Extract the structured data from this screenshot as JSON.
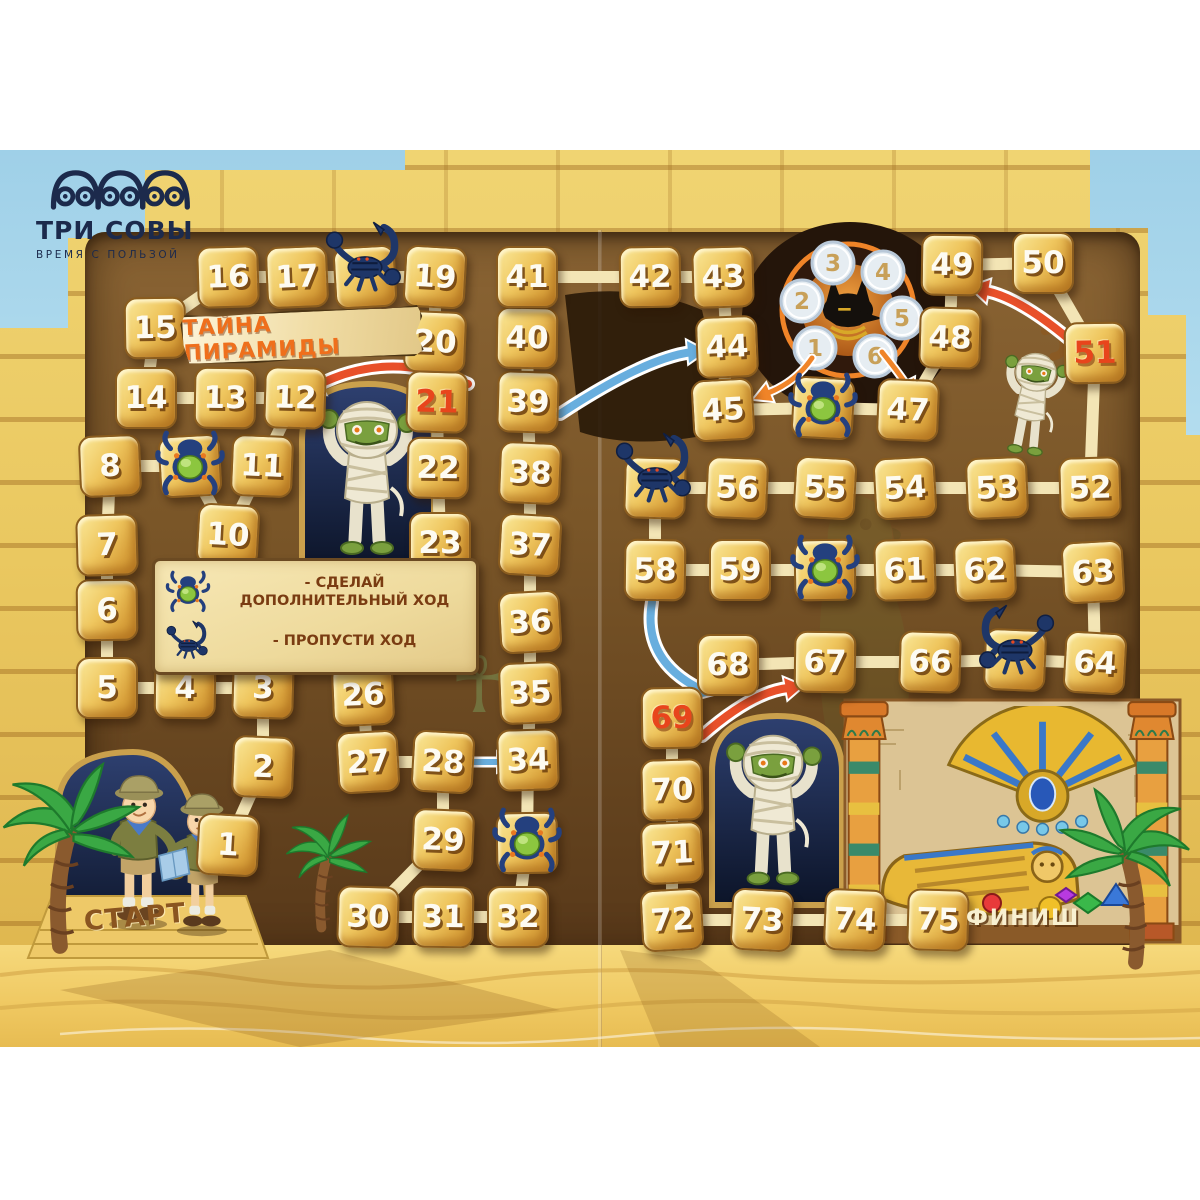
{
  "brand": {
    "name": "ТРИ СОВЫ",
    "tagline": "ВРЕМЯ С ПОЛЬЗОЙ"
  },
  "title": "ТАЙНА ПИРАМИДЫ",
  "labels": {
    "start": "СТАРТ",
    "finish": "ФИНИШ"
  },
  "legend": {
    "items": [
      {
        "icon": "scarab-icon",
        "text": "- СДЕЛАЙ ДОПОЛНИТЕЛЬНЫЙ ХОД"
      },
      {
        "icon": "scorpion-icon",
        "text": "- ПРОПУСТИ ХОД"
      }
    ]
  },
  "colors": {
    "accent_red": "#e8502a",
    "arrow_blue": "#68aede",
    "arrow_orange": "#f08428",
    "path_cream": "#f3e5b5",
    "tile_gold": "#edbf55",
    "panel_brown": "#74522a",
    "sky": "#a8d6ea",
    "sand": "#f2cf6e",
    "logo_navy": "#1c2a4c",
    "title_orange": "#ef6f1c"
  },
  "spinner": {
    "cx": 848,
    "cy": 310,
    "values": [
      {
        "v": "1",
        "x": 815,
        "y": 348
      },
      {
        "v": "2",
        "x": 802,
        "y": 301
      },
      {
        "v": "3",
        "x": 833,
        "y": 263
      },
      {
        "v": "4",
        "x": 883,
        "y": 272
      },
      {
        "v": "5",
        "x": 902,
        "y": 318
      },
      {
        "v": "6",
        "x": 875,
        "y": 356
      }
    ]
  },
  "board": {
    "tiles": [
      {
        "n": 1,
        "x": 228,
        "y": 845,
        "v": "n"
      },
      {
        "n": 2,
        "x": 263,
        "y": 767,
        "v": "n"
      },
      {
        "n": 3,
        "x": 263,
        "y": 688,
        "v": "n"
      },
      {
        "n": 4,
        "x": 185,
        "y": 688,
        "v": "n"
      },
      {
        "n": 5,
        "x": 107,
        "y": 688,
        "v": "n"
      },
      {
        "n": 6,
        "x": 107,
        "y": 610,
        "v": "n"
      },
      {
        "n": 7,
        "x": 107,
        "y": 545,
        "v": "n"
      },
      {
        "n": 8,
        "x": 110,
        "y": 466,
        "v": "n"
      },
      {
        "n": 9,
        "x": 190,
        "y": 466,
        "v": "scarab"
      },
      {
        "n": 10,
        "x": 228,
        "y": 535,
        "v": "n"
      },
      {
        "n": 11,
        "x": 262,
        "y": 466,
        "v": "n"
      },
      {
        "n": 12,
        "x": 295,
        "y": 398,
        "v": "n"
      },
      {
        "n": 13,
        "x": 225,
        "y": 398,
        "v": "n"
      },
      {
        "n": 14,
        "x": 146,
        "y": 398,
        "v": "n"
      },
      {
        "n": 15,
        "x": 155,
        "y": 328,
        "v": "n"
      },
      {
        "n": 16,
        "x": 228,
        "y": 277,
        "v": "n"
      },
      {
        "n": 17,
        "x": 297,
        "y": 277,
        "v": "n"
      },
      {
        "n": 18,
        "x": 365,
        "y": 277,
        "v": "scorpion"
      },
      {
        "n": 19,
        "x": 435,
        "y": 277,
        "v": "n"
      },
      {
        "n": 20,
        "x": 435,
        "y": 342,
        "v": "n"
      },
      {
        "n": 21,
        "x": 437,
        "y": 402,
        "v": "red"
      },
      {
        "n": 22,
        "x": 438,
        "y": 468,
        "v": "n"
      },
      {
        "n": 23,
        "x": 440,
        "y": 543,
        "v": "n"
      },
      {
        "n": 24,
        "x": 443,
        "y": 622,
        "v": "n"
      },
      {
        "n": 25,
        "x": 362,
        "y": 627,
        "v": "scarab"
      },
      {
        "n": 26,
        "x": 363,
        "y": 695,
        "v": "n"
      },
      {
        "n": 27,
        "x": 368,
        "y": 762,
        "v": "n"
      },
      {
        "n": 28,
        "x": 443,
        "y": 762,
        "v": "n"
      },
      {
        "n": 29,
        "x": 443,
        "y": 840,
        "v": "n"
      },
      {
        "n": 30,
        "x": 368,
        "y": 917,
        "v": "n"
      },
      {
        "n": 31,
        "x": 443,
        "y": 917,
        "v": "n"
      },
      {
        "n": 32,
        "x": 518,
        "y": 917,
        "v": "n"
      },
      {
        "n": 33,
        "x": 527,
        "y": 843,
        "v": "scarab"
      },
      {
        "n": 34,
        "x": 528,
        "y": 760,
        "v": "n"
      },
      {
        "n": 35,
        "x": 530,
        "y": 693,
        "v": "n"
      },
      {
        "n": 36,
        "x": 530,
        "y": 622,
        "v": "n"
      },
      {
        "n": 37,
        "x": 530,
        "y": 545,
        "v": "n"
      },
      {
        "n": 38,
        "x": 530,
        "y": 473,
        "v": "n"
      },
      {
        "n": 39,
        "x": 528,
        "y": 402,
        "v": "n"
      },
      {
        "n": 40,
        "x": 527,
        "y": 338,
        "v": "n"
      },
      {
        "n": 41,
        "x": 527,
        "y": 277,
        "v": "n"
      },
      {
        "n": 42,
        "x": 650,
        "y": 277,
        "v": "n"
      },
      {
        "n": 43,
        "x": 723,
        "y": 277,
        "v": "n"
      },
      {
        "n": 44,
        "x": 727,
        "y": 347,
        "v": "n"
      },
      {
        "n": 45,
        "x": 723,
        "y": 410,
        "v": "n"
      },
      {
        "n": 46,
        "x": 823,
        "y": 408,
        "v": "scarab"
      },
      {
        "n": 47,
        "x": 908,
        "y": 410,
        "v": "n"
      },
      {
        "n": 48,
        "x": 950,
        "y": 338,
        "v": "n"
      },
      {
        "n": 49,
        "x": 952,
        "y": 265,
        "v": "n"
      },
      {
        "n": 50,
        "x": 1043,
        "y": 263,
        "v": "n"
      },
      {
        "n": 51,
        "x": 1095,
        "y": 353,
        "v": "red"
      },
      {
        "n": 52,
        "x": 1090,
        "y": 488,
        "v": "n"
      },
      {
        "n": 53,
        "x": 997,
        "y": 488,
        "v": "n"
      },
      {
        "n": 54,
        "x": 905,
        "y": 488,
        "v": "n"
      },
      {
        "n": 55,
        "x": 825,
        "y": 488,
        "v": "n"
      },
      {
        "n": 56,
        "x": 737,
        "y": 488,
        "v": "n"
      },
      {
        "n": 57,
        "x": 655,
        "y": 488,
        "v": "scorpion"
      },
      {
        "n": 58,
        "x": 655,
        "y": 570,
        "v": "n"
      },
      {
        "n": 59,
        "x": 740,
        "y": 570,
        "v": "n"
      },
      {
        "n": 60,
        "x": 825,
        "y": 570,
        "v": "scarab"
      },
      {
        "n": 61,
        "x": 905,
        "y": 570,
        "v": "n"
      },
      {
        "n": 62,
        "x": 985,
        "y": 570,
        "v": "n"
      },
      {
        "n": 63,
        "x": 1093,
        "y": 572,
        "v": "n"
      },
      {
        "n": 64,
        "x": 1095,
        "y": 663,
        "v": "n"
      },
      {
        "n": 65,
        "x": 1015,
        "y": 660,
        "v": "scorpion"
      },
      {
        "n": 66,
        "x": 930,
        "y": 662,
        "v": "n"
      },
      {
        "n": 67,
        "x": 825,
        "y": 662,
        "v": "n"
      },
      {
        "n": 68,
        "x": 728,
        "y": 665,
        "v": "n"
      },
      {
        "n": 69,
        "x": 672,
        "y": 718,
        "v": "red"
      },
      {
        "n": 70,
        "x": 672,
        "y": 790,
        "v": "n"
      },
      {
        "n": 71,
        "x": 672,
        "y": 853,
        "v": "n"
      },
      {
        "n": 72,
        "x": 672,
        "y": 920,
        "v": "n"
      },
      {
        "n": 73,
        "x": 762,
        "y": 920,
        "v": "n"
      },
      {
        "n": 74,
        "x": 855,
        "y": 920,
        "v": "n"
      },
      {
        "n": 75,
        "x": 938,
        "y": 920,
        "v": "n"
      }
    ],
    "arrows": [
      {
        "name": "arrow-21-to-12",
        "color": "#e8502a",
        "w": 8,
        "uw": 14,
        "d": "M 468,384 Q 390,348 316,386",
        "head": "303,392 314,374 325,394"
      },
      {
        "name": "arrow-39-to-44",
        "color": "#68aede",
        "w": 8,
        "uw": 14,
        "d": "M 560,414 Q 645,358 692,352",
        "head": "706,351 689,363 687,341"
      },
      {
        "name": "arrow-28-to-34",
        "color": "#68aede",
        "w": 6,
        "uw": 11,
        "d": "M 470,762 L 500,762",
        "head": "512,762 498,771 498,753"
      },
      {
        "name": "arrow-51-to-49",
        "color": "#e8502a",
        "w": 8,
        "uw": 14,
        "d": "M 1070,340 Q 1020,298 986,291",
        "head": "970,287 990,280 986,302"
      },
      {
        "name": "arrow-58-to-68",
        "color": "#68aede",
        "w": 8,
        "uw": 14,
        "d": "M 652,602 Q 642,660 700,689",
        "head": "714,694 695,699 702,678"
      },
      {
        "name": "arrow-69-to-67",
        "color": "#e8502a",
        "w": 8,
        "uw": 14,
        "d": "M 702,736 Q 752,692 788,688",
        "head": "803,686 788,699 784,678"
      },
      {
        "name": "arrow-spinner-to-45",
        "color": "#f08428",
        "w": 5,
        "uw": 9,
        "d": "M 812,358 Q 796,382 768,393",
        "head": "754,399 766,384 773,401"
      },
      {
        "name": "arrow-spinner-to-47",
        "color": "#f08428",
        "w": 5,
        "uw": 9,
        "d": "M 882,352 Q 898,372 906,384",
        "head": "913,397 898,386 914,378"
      }
    ]
  }
}
